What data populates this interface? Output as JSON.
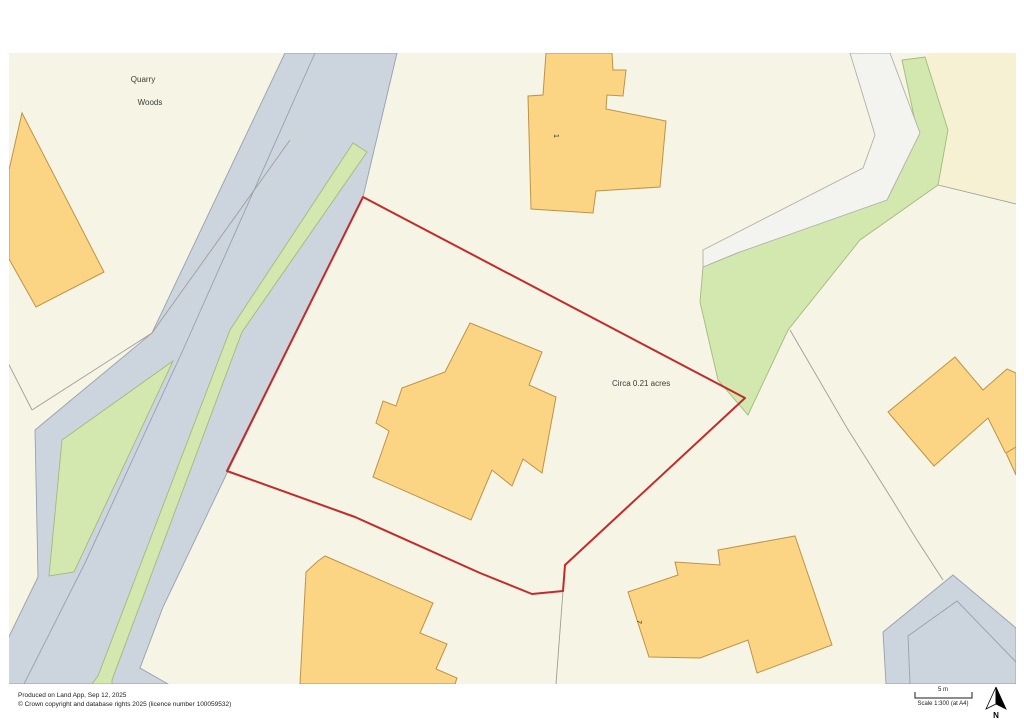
{
  "map": {
    "labels": {
      "place_line1": "Quarry",
      "place_line2": "Woods",
      "area_annotation": "Circa 0.21 acres",
      "building_number_top": "1",
      "building_number_bottom": "7"
    }
  },
  "footer": {
    "produced": "Produced on Land App, Sep 12, 2025",
    "copyright": "© Crown copyright and database rights 2025 (licence number 100059532)",
    "scale_distance": "5 m",
    "scale_text": "Scale 1:300 (at A4)",
    "north_label": "N"
  },
  "colors": {
    "background": "#ffffff",
    "land": "#f6f4e4",
    "land-pale": "#f5f1d2",
    "road": "#ccd4de",
    "road-edge": "#97a0ae",
    "green": "#d3e8af",
    "green-edge": "#a3b97c",
    "track": "#f3f3f0",
    "track-edge": "#b3b0a8",
    "building": "#fcd584",
    "building-edge": "#bd9348",
    "boundary-red": "#c22b2b",
    "parcel-line": "#a09e96",
    "label-text": "#3c3c3c"
  }
}
